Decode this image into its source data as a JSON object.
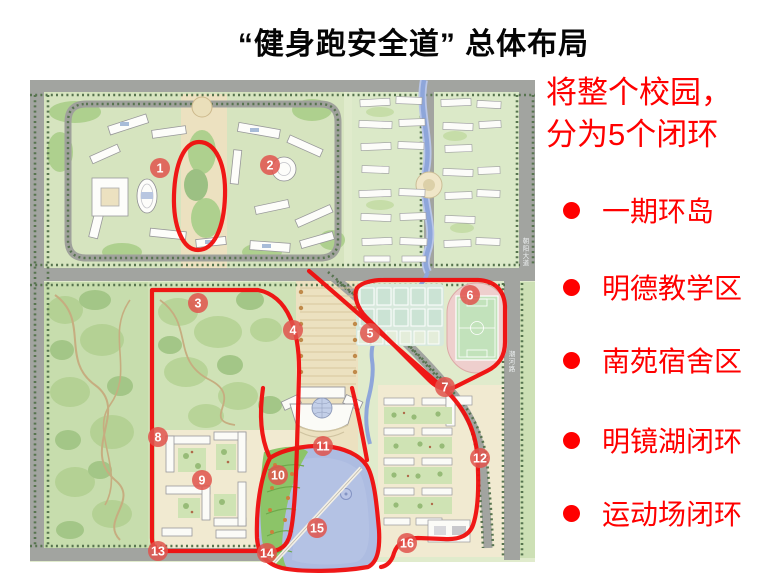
{
  "slide": {
    "title": "“健身跑安全道” 总体布局"
  },
  "legend": {
    "header_lines": [
      "将整个校园，",
      "分为5个闭环"
    ],
    "items": [
      {
        "label": "一期环岛"
      },
      {
        "label": "明德教学区"
      },
      {
        "label": "南苑宿舍区"
      },
      {
        "label": "明镜湖闭环"
      },
      {
        "label": "运动场闭环"
      }
    ],
    "accent_color": "#ff0000"
  },
  "map": {
    "markers": [
      {
        "n": "1",
        "x": 160,
        "y": 168
      },
      {
        "n": "2",
        "x": 270,
        "y": 165
      },
      {
        "n": "3",
        "x": 198,
        "y": 303
      },
      {
        "n": "4",
        "x": 293,
        "y": 330
      },
      {
        "n": "5",
        "x": 370,
        "y": 333
      },
      {
        "n": "6",
        "x": 470,
        "y": 295
      },
      {
        "n": "7",
        "x": 445,
        "y": 387
      },
      {
        "n": "8",
        "x": 158,
        "y": 437
      },
      {
        "n": "9",
        "x": 202,
        "y": 480
      },
      {
        "n": "10",
        "x": 278,
        "y": 475
      },
      {
        "n": "11",
        "x": 323,
        "y": 446
      },
      {
        "n": "12",
        "x": 480,
        "y": 458
      },
      {
        "n": "13",
        "x": 158,
        "y": 551
      },
      {
        "n": "14",
        "x": 267,
        "y": 553
      },
      {
        "n": "15",
        "x": 317,
        "y": 528
      },
      {
        "n": "16",
        "x": 407,
        "y": 543
      }
    ],
    "road_labels": [
      {
        "text": "朝阳大道",
        "x": 526,
        "y": 243
      },
      {
        "text": "潮河路",
        "x": 512,
        "y": 356
      }
    ],
    "colors": {
      "route": "#f00d0d",
      "marker_fill": "#e0544c",
      "lake": "#adbce1",
      "track": "#eecfcd",
      "field": "#c2e2bb",
      "road": "#a2a4a0",
      "campus_green": "#d6e4bf"
    }
  }
}
